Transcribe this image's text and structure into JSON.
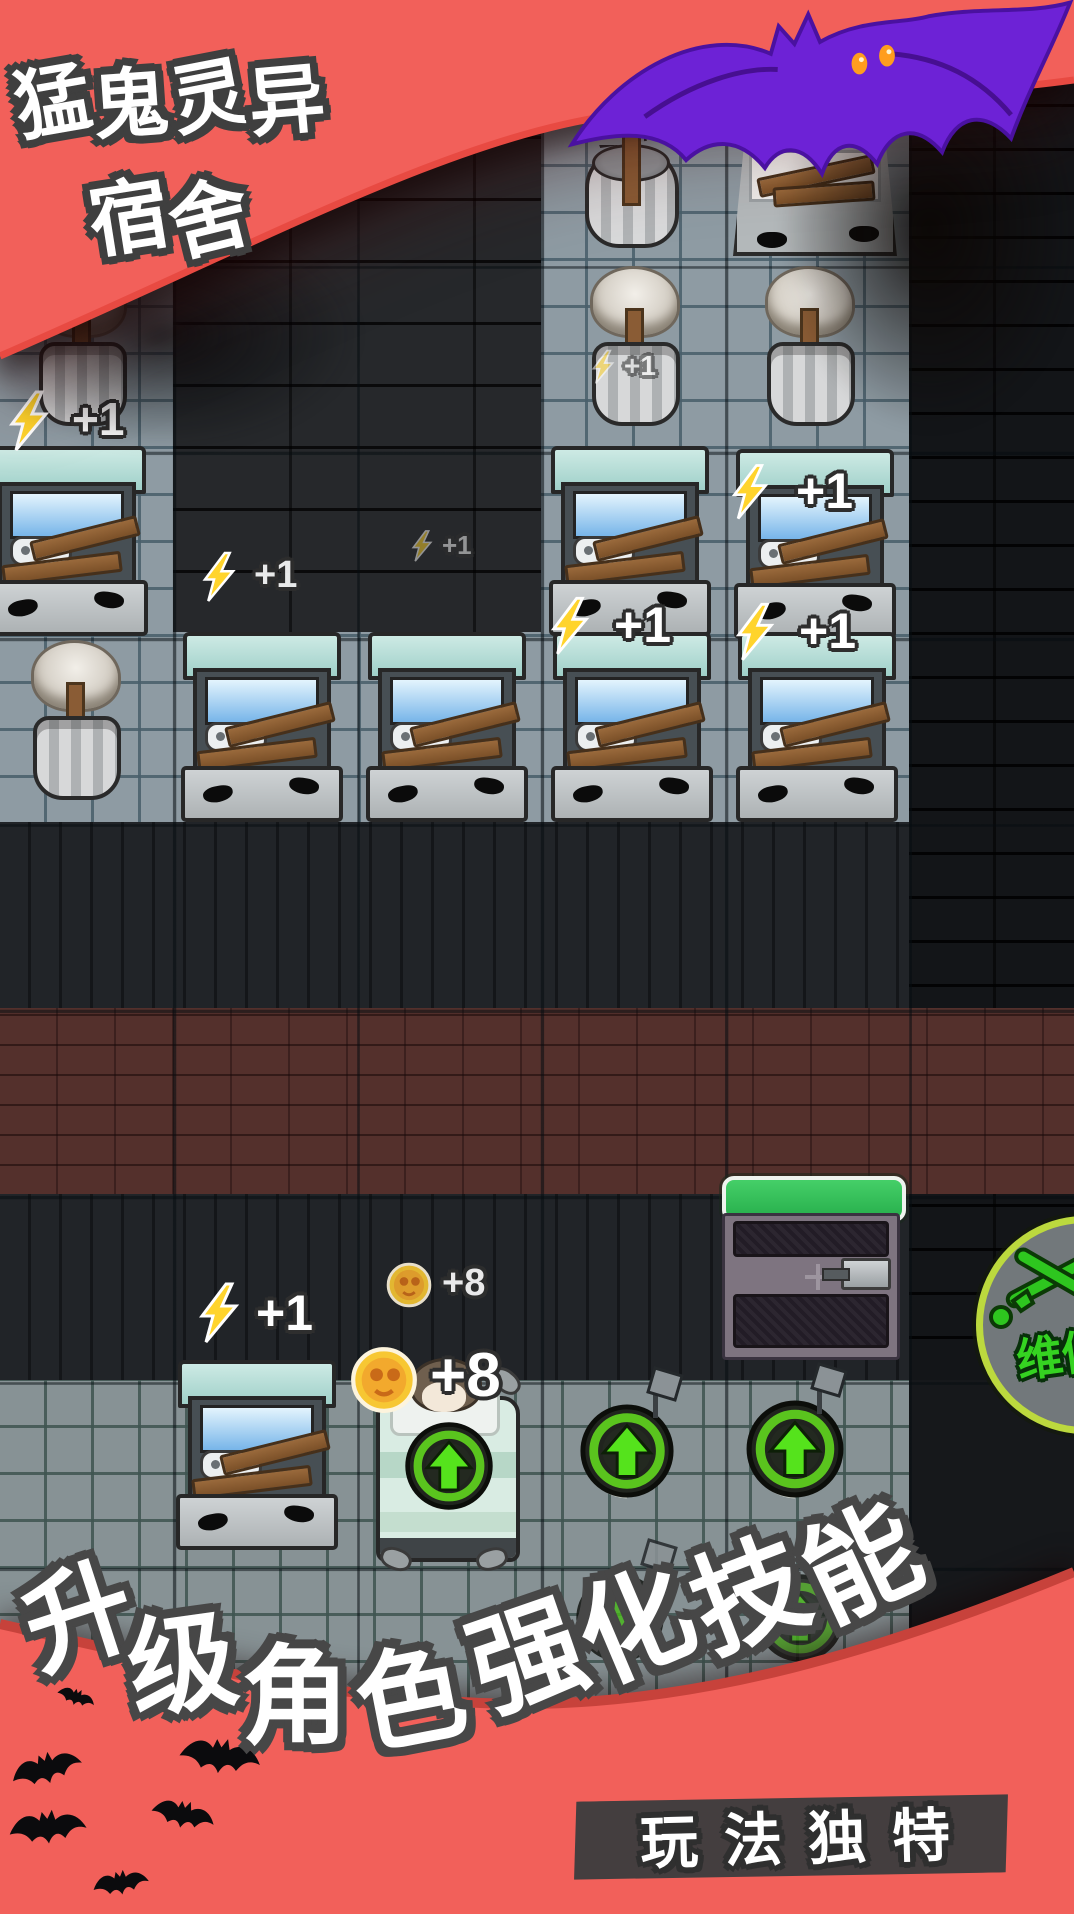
{
  "header": {
    "title_line1": "猛鬼灵异",
    "title_line2": "宿舍"
  },
  "floaters": [
    {
      "name": "energy-gain-1",
      "icon": "lightning-icon",
      "label": "+1"
    },
    {
      "name": "energy-gain-2",
      "icon": "lightning-icon",
      "label": "+1"
    },
    {
      "name": "energy-gain-3",
      "icon": "lightning-icon",
      "label": "+1"
    },
    {
      "name": "energy-gain-4",
      "icon": "lightning-icon",
      "label": "+1"
    },
    {
      "name": "energy-gain-5",
      "icon": "lightning-icon",
      "label": "+1"
    },
    {
      "name": "energy-gain-6",
      "icon": "lightning-icon",
      "label": "+1"
    },
    {
      "name": "energy-gain-7",
      "icon": "lightning-icon",
      "label": "+1"
    },
    {
      "name": "energy-gain-8",
      "icon": "lightning-icon",
      "label": "+1"
    },
    {
      "name": "coin-gain-small",
      "icon": "coin-icon",
      "label": "+8"
    },
    {
      "name": "coin-gain-large",
      "icon": "coin-icon",
      "label": "+8"
    }
  ],
  "hud": {
    "repair_label": "维修"
  },
  "footer": {
    "caption_left": "升级角色",
    "caption_right": "强化技能",
    "banner_label": "玩法独特"
  },
  "colors": {
    "top_banner_red": "#f2605a",
    "banner_rim_red": "#d8453e",
    "health_green": "#2cc055",
    "upgrade_green": "#55e31c",
    "repair_ring": "#bcd93e",
    "coin_yellow": "#f7c733",
    "bat_purple": "#6d22d6",
    "maroon_brick": "#54302c"
  }
}
